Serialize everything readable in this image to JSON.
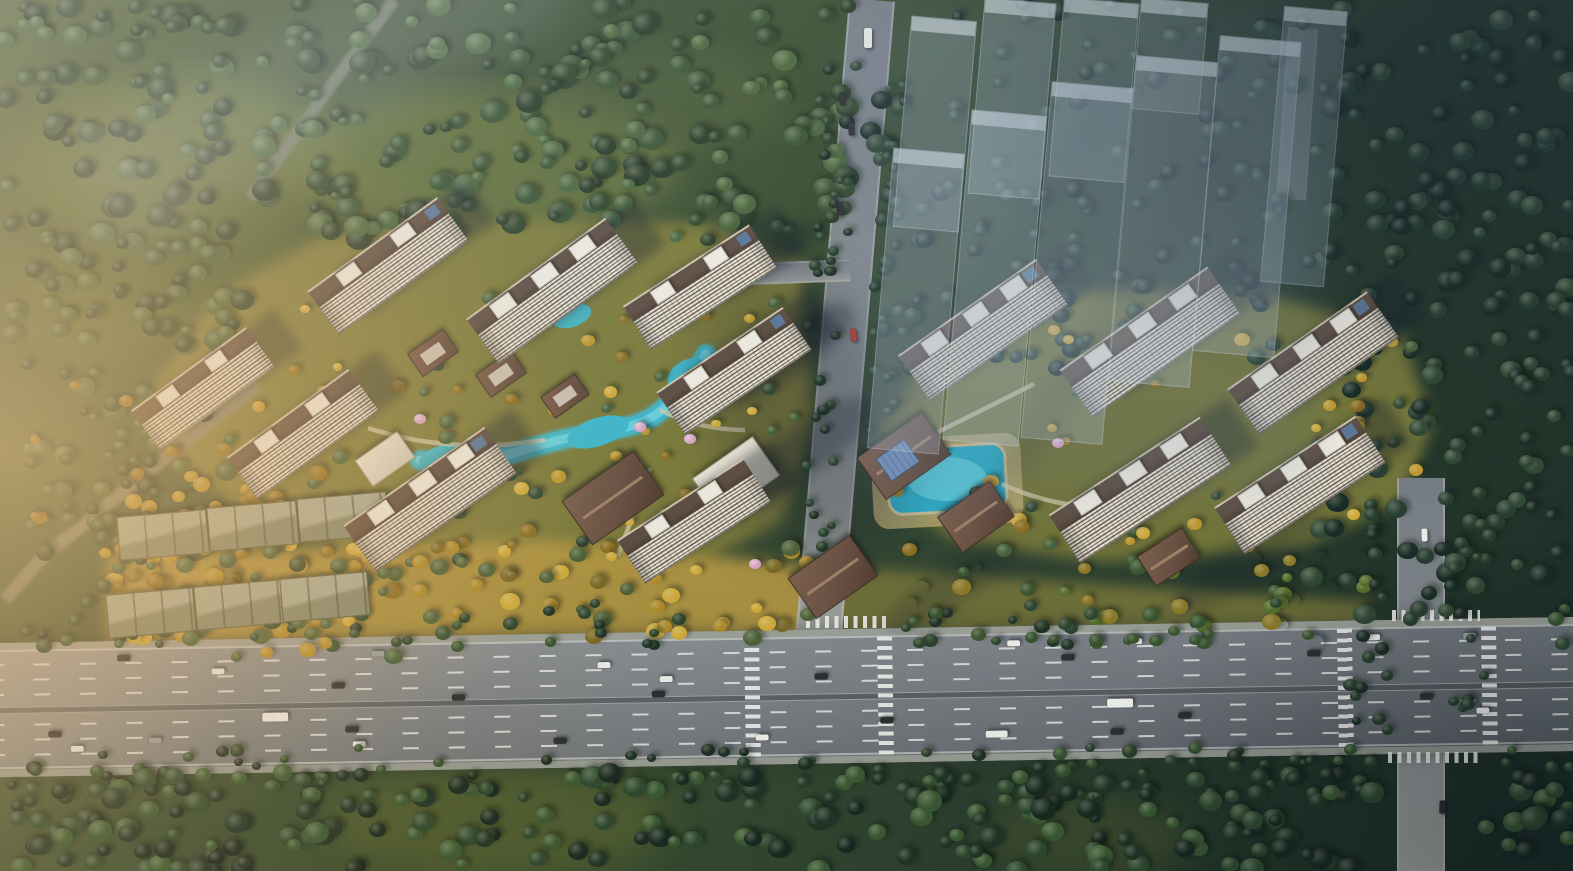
{
  "scene": {
    "title": "aerial-rendering-residential-development",
    "description": "bird's-eye architectural rendering: two residential tower clusters with landscaped gardens and ponds, ghosted future-phase buildings upper right, forest surround, multi-lane highway across the bottom with two intersections",
    "palette": {
      "forest_base": "#2c4230",
      "clearing": "#64723b",
      "garden_olive": "#7d7b3a",
      "garden_olive_right": "#727439",
      "gold_strip": "#b39742",
      "strip_right": "#6e7037",
      "road_gray": "#868d92",
      "road_faint": "#93a0aa",
      "access_road": "#8a8772",
      "forest_road": "#78816f",
      "water": "#3fb9cd",
      "water_light": "#74d7e4",
      "pool": "#2aafc9",
      "pool_light": "#63d2e2",
      "deck": "#b9ab72",
      "path": "#d9cfae",
      "glow": "#ffc46e"
    },
    "clearings": [
      [
        175,
        160,
        165,
        85,
        "#5e6e38",
        0.9
      ],
      [
        485,
        162,
        195,
        72,
        "#66743c",
        0.85
      ],
      [
        95,
        300,
        95,
        62,
        "#5a6a36",
        0.8
      ],
      [
        215,
        245,
        120,
        55,
        "#4d6033",
        0.6
      ],
      [
        665,
        100,
        120,
        55,
        "#51643a",
        0.5
      ],
      [
        498,
        820,
        170,
        52,
        "#4f5e33",
        0.9
      ],
      [
        1085,
        838,
        105,
        40,
        "#3c4d2d",
        0.8
      ]
    ],
    "forest_regions": [
      {
        "name": "forest-top-left",
        "r": [
          0,
          0,
          850,
          240
        ],
        "count": 240,
        "size": [
          12,
          27
        ],
        "pal": [
          "#3a5434",
          "#273b26",
          "#49663c",
          "#2f462c"
        ]
      },
      {
        "name": "forest-left-edge",
        "r": [
          0,
          225,
          250,
          340
        ],
        "count": 90,
        "size": [
          12,
          24
        ],
        "pal": [
          "#3f5a36",
          "#2a3f28",
          "#4a6338"
        ]
      },
      {
        "name": "clearing-sparse",
        "r": [
          280,
          60,
          440,
          180
        ],
        "count": 22,
        "size": [
          10,
          18
        ],
        "pal": [
          "#3c5531",
          "#2c4128"
        ]
      },
      {
        "name": "forest-right",
        "r": [
          1308,
          0,
          265,
          620
        ],
        "count": 160,
        "size": [
          12,
          24
        ],
        "pal": [
          "#263d30",
          "#172a24",
          "#2e4734"
        ]
      },
      {
        "name": "forest-behind-ghost",
        "r": [
          845,
          0,
          465,
          215
        ],
        "count": 60,
        "size": [
          12,
          22
        ],
        "pal": [
          "#20352b",
          "#152621",
          "#28402f"
        ]
      },
      {
        "name": "forest-mid-right",
        "r": [
          880,
          185,
          430,
          185
        ],
        "count": 70,
        "size": [
          11,
          20
        ],
        "pal": [
          "#22382c",
          "#182a23",
          "#2a4230"
        ]
      },
      {
        "name": "garden-left",
        "r": [
          200,
          298,
          595,
          262
        ],
        "count": 72,
        "size": [
          9,
          17
        ],
        "pal": [
          "#c2992e",
          "#8e6f20",
          "#46613a",
          "#2f4831",
          "#d3ad3c"
        ]
      },
      {
        "name": "garden-right",
        "r": [
          892,
          328,
          530,
          230
        ],
        "count": 58,
        "size": [
          9,
          17
        ],
        "pal": [
          "#c2992e",
          "#8e6f20",
          "#46613a",
          "#2f4831",
          "#d3ad3c"
        ]
      },
      {
        "name": "strip-gold",
        "r": [
          112,
          545,
          700,
          95
        ],
        "count": 82,
        "size": [
          10,
          20
        ],
        "pal": [
          "#d3ad3c",
          "#b08c2a",
          "#7b6a24",
          "#4c6238"
        ]
      },
      {
        "name": "strip-mid",
        "r": [
          812,
          555,
          570,
          90
        ],
        "count": 55,
        "size": [
          10,
          19
        ],
        "pal": [
          "#58702c",
          "#3b552f",
          "#97right",
          "#8d7a28"
        ],
        "gaps": [
          [
            758,
            908
          ]
        ]
      },
      {
        "name": "treeline-top",
        "r": [
          0,
          602,
          1573,
          46
        ],
        "count": 112,
        "size": [
          9,
          16
        ],
        "pal": [
          "#2c452e",
          "#1e3325",
          "#35522f"
        ],
        "gaps": [
          [
            688,
            905
          ],
          [
            1286,
            1548
          ]
        ]
      },
      {
        "name": "treeline-bottom",
        "r": [
          0,
          746,
          1573,
          54
        ],
        "count": 112,
        "size": [
          9,
          16
        ],
        "pal": [
          "#293f2b",
          "#1c2f23",
          "#32502e"
        ],
        "gaps": [
          [
            1374,
            1486
          ]
        ]
      },
      {
        "name": "forest-bottom",
        "r": [
          0,
          772,
          1573,
          99
        ],
        "count": 240,
        "size": [
          12,
          26
        ],
        "pal": [
          "#2e4a30",
          "#203527",
          "#3a5a33",
          "#182a21"
        ],
        "gaps": [
          [
            1376,
            1484
          ]
        ]
      },
      {
        "name": "garage-grove",
        "r": [
          92,
          462,
          305,
          195
        ],
        "count": 85,
        "size": [
          10,
          19
        ],
        "pal": [
          "#b8912c",
          "#8e6f20",
          "#44603a",
          "#33492e"
        ]
      },
      {
        "name": "roadside-ul",
        "r": [
          818,
          58,
          30,
          195
        ],
        "count": 14,
        "size": [
          8,
          13
        ],
        "pal": [
          "#26402c",
          "#1a2f23"
        ]
      },
      {
        "name": "roadside-ur",
        "r": [
          884,
          58,
          26,
          195
        ],
        "count": 12,
        "size": [
          8,
          13
        ],
        "pal": [
          "#26402c",
          "#1a2f23"
        ]
      },
      {
        "name": "roadside-ll",
        "r": [
          806,
          255,
          30,
          300
        ],
        "count": 18,
        "size": [
          8,
          13
        ],
        "pal": [
          "#26402c",
          "#1a2f23"
        ]
      },
      {
        "name": "roadside-lr",
        "r": [
          868,
          255,
          28,
          180
        ],
        "count": 12,
        "size": [
          8,
          13
        ],
        "pal": [
          "#26402c",
          "#1a2f23"
        ]
      },
      {
        "name": "roadside-right-a",
        "r": [
          1348,
          492,
          42,
          252
        ],
        "count": 18,
        "size": [
          9,
          15
        ],
        "pal": [
          "#243b2b",
          "#182a22"
        ]
      },
      {
        "name": "roadside-right-b",
        "r": [
          1452,
          492,
          40,
          252
        ],
        "count": 16,
        "size": [
          9,
          15
        ],
        "pal": [
          "#243b2b",
          "#182a22"
        ]
      },
      {
        "name": "access-grove",
        "r": [
          30,
          380,
          230,
          190
        ],
        "count": 40,
        "size": [
          9,
          15
        ],
        "pal": [
          "#3f5a36",
          "#2a3f28",
          "#8e6f20"
        ]
      }
    ],
    "blossoms": [
      [
        362,
        404
      ],
      [
        480,
        442
      ],
      [
        640,
        428
      ],
      [
        690,
        440
      ],
      [
        905,
        432
      ],
      [
        1058,
        444
      ],
      [
        755,
        565
      ],
      [
        420,
        420
      ]
    ],
    "towers": [
      [
        388,
        266,
        160,
        54,
        -36
      ],
      [
        552,
        291,
        172,
        56,
        -36
      ],
      [
        700,
        287,
        150,
        52,
        -33
      ],
      [
        203,
        389,
        142,
        50,
        -36
      ],
      [
        734,
        371,
        152,
        52,
        -34
      ],
      [
        303,
        434,
        150,
        52,
        -36
      ],
      [
        430,
        499,
        172,
        57,
        -35
      ],
      [
        694,
        521,
        150,
        52,
        -33
      ],
      [
        983,
        330,
        168,
        56,
        -35
      ],
      [
        1150,
        342,
        180,
        58,
        -35
      ],
      [
        1313,
        363,
        170,
        56,
        -35
      ],
      [
        1140,
        490,
        180,
        58,
        -33
      ],
      [
        1300,
        485,
        168,
        56,
        -33
      ]
    ],
    "lowrise": [
      [
        162,
        534,
        88,
        42,
        -5
      ],
      [
        252,
        525,
        88,
        42,
        -5
      ],
      [
        342,
        516,
        88,
        42,
        -5
      ],
      [
        150,
        612,
        86,
        42,
        -5
      ],
      [
        238,
        604,
        86,
        42,
        -5
      ],
      [
        324,
        596,
        86,
        42,
        -5
      ]
    ],
    "pavilions": [
      {
        "n": "gate-left",
        "v": [
          612,
          497,
          86,
          52,
          -35
        ],
        "glass": false
      },
      {
        "n": "pavilion-mid",
        "v": [
          832,
          576,
          74,
          48,
          -35
        ],
        "glass": false
      },
      {
        "n": "clubhouse-right",
        "v": [
          903,
          455,
          78,
          50,
          -35
        ],
        "glass": true
      },
      {
        "n": "pavilion-right",
        "v": [
          975,
          516,
          62,
          42,
          -35
        ],
        "glass": false
      },
      {
        "n": "gate-right",
        "v": [
          1168,
          556,
          52,
          34,
          -33
        ],
        "glass": false
      }
    ],
    "canopies": [
      [
        735,
        476,
        72,
        46,
        -35
      ],
      [
        384,
        458,
        50,
        30,
        -35
      ]
    ],
    "villas": [
      [
        432,
        352,
        42,
        26,
        -35
      ],
      [
        500,
        373,
        42,
        26,
        -35
      ],
      [
        564,
        395,
        40,
        24,
        -35
      ]
    ],
    "ghost_buildings": [
      [
        880,
        150,
        70,
        300,
        0.3
      ],
      [
        957,
        112,
        74,
        330,
        0.33
      ],
      [
        1036,
        84,
        80,
        356,
        0.3
      ],
      [
        902,
        18,
        64,
        210,
        0.27
      ],
      [
        976,
        0,
        70,
        195,
        0.29
      ],
      [
        1056,
        0,
        74,
        178,
        0.25
      ],
      [
        1122,
        58,
        80,
        325,
        0.32
      ],
      [
        1206,
        38,
        80,
        315,
        0.29
      ],
      [
        1272,
        8,
        62,
        275,
        0.25
      ],
      [
        1136,
        0,
        66,
        110,
        0.21
      ]
    ],
    "ground_shadows": [
      [
        805,
        420,
        180,
        280,
        -18,
        0.26,
        26
      ],
      [
        790,
        352,
        150,
        44,
        -35,
        0.3,
        6
      ],
      [
        802,
        452,
        170,
        48,
        -35,
        0.3,
        6
      ],
      [
        768,
        258,
        120,
        32,
        -35,
        0.28,
        6
      ],
      [
        1248,
        560,
        170,
        44,
        -33,
        0.22,
        8
      ],
      [
        952,
        586,
        150,
        40,
        -33,
        0.2,
        8
      ],
      [
        1008,
        250,
        420,
        40,
        -56,
        0.16,
        10
      ],
      [
        1120,
        306,
        430,
        44,
        -56,
        0.13,
        10
      ]
    ],
    "highway": {
      "name": "main-highway",
      "left": -20,
      "top": 630,
      "width": 1620,
      "height": 134,
      "angle": -0.95,
      "lanes_a": [
        21,
        36,
        51
      ],
      "lanes_b": [
        81,
        96,
        111
      ],
      "solid": [
        7,
        124
      ],
      "median_y": 64,
      "crosswalks": [
        765,
        898,
        1358,
        1502
      ],
      "cars": [
        [
          138,
          14,
          "d"
        ],
        [
          232,
          29,
          "w"
        ],
        [
          352,
          45,
          "d"
        ],
        [
          392,
          14,
          "g"
        ],
        [
          472,
          59,
          "d"
        ],
        [
          618,
          29,
          "w"
        ],
        [
          672,
          59,
          "d"
        ],
        [
          680,
          44,
          "w"
        ],
        [
          835,
          44,
          "d"
        ],
        [
          1028,
          14,
          "w"
        ],
        [
          1082,
          29,
          "d"
        ],
        [
          1150,
          14,
          "w"
        ],
        [
          1328,
          29,
          "d"
        ],
        [
          1388,
          14,
          "w"
        ],
        [
          1484,
          14,
          "g"
        ],
        [
          68,
          89,
          "d"
        ],
        [
          90,
          104,
          "w"
        ],
        [
          168,
          97,
          "g"
        ],
        [
          282,
          74,
          "T"
        ],
        [
          365,
          89,
          "d"
        ],
        [
          372,
          104,
          "w"
        ],
        [
          573,
          104,
          "d"
        ],
        [
          775,
          104,
          "w"
        ],
        [
          1005,
          104,
          "W"
        ],
        [
          900,
          89,
          "d"
        ],
        [
          1127,
          74,
          "T"
        ],
        [
          1130,
          104,
          "d"
        ],
        [
          1198,
          89,
          "d"
        ],
        [
          1440,
          74,
          "d"
        ],
        [
          1496,
          89,
          "w"
        ]
      ]
    },
    "cross_roads": [
      {
        "n": "center-avenue",
        "left": 849,
        "top": 0,
        "w": 46,
        "h": 655,
        "rot": 4.8,
        "origin": "50% 0"
      },
      {
        "n": "right-avenue",
        "left": 1397,
        "top": 478,
        "w": 48,
        "h": 400,
        "rot": 0,
        "origin": "50% 0"
      },
      {
        "n": "right-avenue-far",
        "left": 1288,
        "top": 28,
        "w": 30,
        "h": 172,
        "rot": 4,
        "origin": "50% 0",
        "op": 0.38
      },
      {
        "n": "branch-road",
        "left": 700,
        "top": 262,
        "w": 150,
        "h": 22,
        "rot": -2,
        "origin": "50% 50%",
        "bar": true
      }
    ],
    "small_crosswalks": [
      [
        806,
        616,
        84,
        12
      ],
      [
        1392,
        610,
        88,
        11
      ],
      [
        1388,
        752,
        92,
        11
      ]
    ],
    "vehicles": [
      [
        858,
        34,
        "W",
        90
      ],
      [
        845,
        126,
        "d",
        86
      ],
      [
        847,
        332,
        "r",
        86
      ],
      [
        1418,
        532,
        "w",
        88
      ],
      [
        1436,
        804,
        "d",
        92
      ],
      [
        836,
        96,
        "d",
        86
      ],
      [
        834,
        206,
        "d",
        86
      ]
    ],
    "car_colors": {
      "d": "#2b2e31",
      "w": "#f1f1ed",
      "g": "#9aa0a3",
      "r": "#b03a30",
      "T": "#f4f4f0",
      "W": "#eef0ea"
    }
  }
}
